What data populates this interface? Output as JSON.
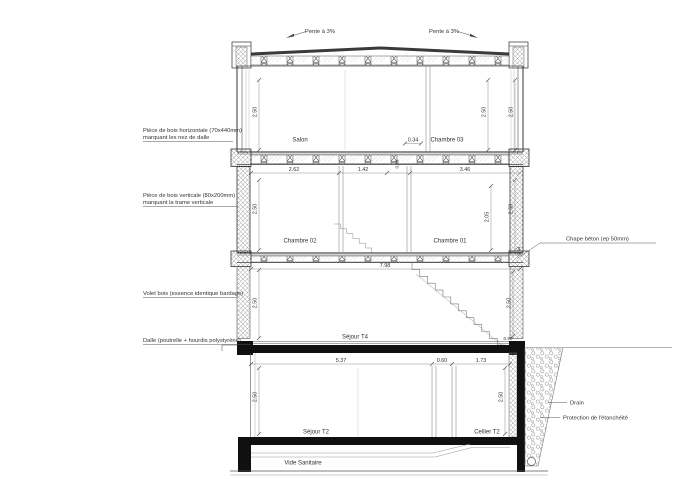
{
  "colors": {
    "line": "#3a3a3a",
    "black_fill": "#101010",
    "hatch": "#9a9a9a",
    "background": "#ffffff"
  },
  "roof": {
    "pente_left": "Pente à 3%",
    "pente_right": "Pente à 3%"
  },
  "labels_left": {
    "nez_dalle_1": "Pièce de bois horizontale (70x440mm)",
    "nez_dalle_2": "marquant les nez de dalle",
    "trame_1": "Pièce de bois verticale (80x200mm)",
    "trame_2": "marquant la trame verticale",
    "volet": "Volet bois (essence identique bardage)",
    "dalle": "Dalle (poutrelle + hourdis polystyrène)"
  },
  "labels_right": {
    "chape": "Chape béton (ep 50mm)",
    "drain": "Drain",
    "protection": "Protection de l'étanchéité"
  },
  "rooms": {
    "salon": "Salon",
    "chambre03": "Chambre 03",
    "chambre02": "Chambre 02",
    "chambre01": "Chambre 01",
    "sejour_t4": "Séjour T4",
    "sejour_t2": "Séjour T2",
    "cellier_t2": "Cellier T2",
    "vide_sanitaire": "Vide Sanitaire"
  },
  "dims": {
    "f2_h_left": "2.50",
    "f2_h_mid": "2.50",
    "f2_h_right": "2.50",
    "f2_w_small": "0.34",
    "f1_w1": "2.62",
    "f1_w2": "1.42",
    "f1_w3": "0.68",
    "f1_w4": "3.46",
    "f1_h_left": "2.50",
    "f1_h_mid": "2.05",
    "f1_h_right": "2.50",
    "f1_end": "0.44",
    "f1_total": "7.98",
    "g_h_left": "2.50",
    "g_h_right": "2.50",
    "g_rail": "0.90",
    "b_w1": "5.37",
    "b_w2": "0.60",
    "b_w3": "1.73",
    "b_h_left": "2.50",
    "b_h_right": "2.50"
  }
}
